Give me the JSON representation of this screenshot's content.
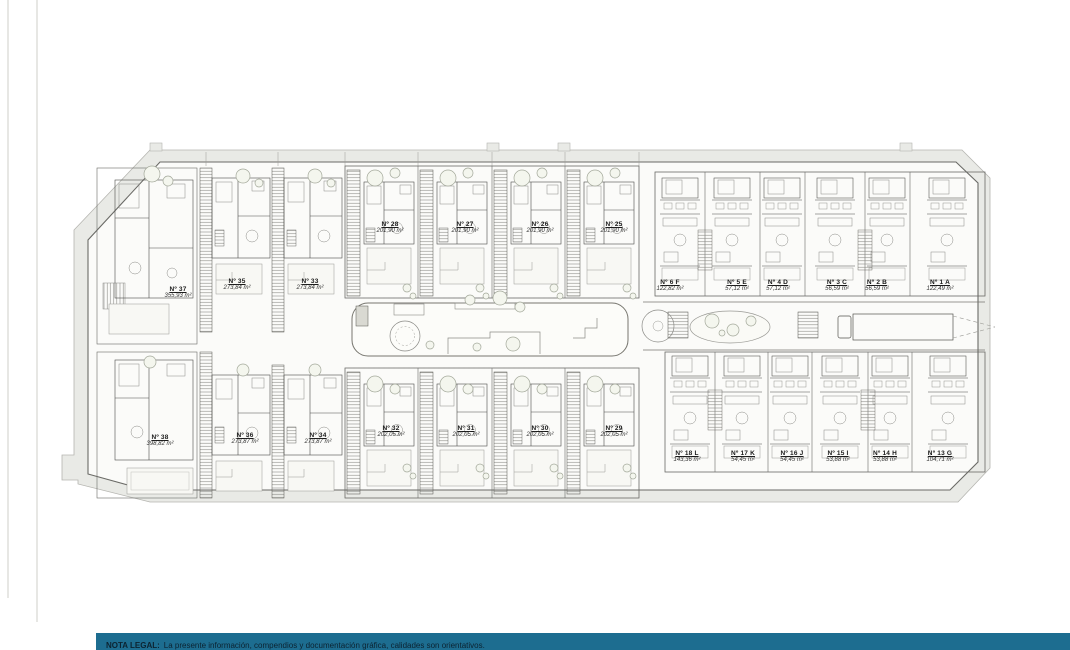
{
  "colors": {
    "teal_bar": "#1d6d90",
    "site_band": "#e9eae6",
    "plan_line": "#4d4d4a"
  },
  "legal": {
    "label": "NOTA LEGAL:",
    "text": "La presente información, compendios y documentación gráfica, calidades son orientativos."
  },
  "units": {
    "villas_top": [
      {
        "label": "Nº 37",
        "area": "355,93 m²"
      },
      {
        "label": "Nº 35",
        "area": "273,84 m²"
      },
      {
        "label": "Nº 33",
        "area": "273,84 m²"
      },
      {
        "label": "Nº 28",
        "area": "201,90 m²"
      },
      {
        "label": "Nº 27",
        "area": "201,90 m²"
      },
      {
        "label": "Nº 26",
        "area": "201,90 m²"
      },
      {
        "label": "Nº 25",
        "area": "201,90 m²"
      }
    ],
    "villas_bottom": [
      {
        "label": "Nº 38",
        "area": "398,82 m²"
      },
      {
        "label": "Nº 36",
        "area": "273,87 m²"
      },
      {
        "label": "Nº 34",
        "area": "273,87 m²"
      },
      {
        "label": "Nº 32",
        "area": "202,05 m²"
      },
      {
        "label": "Nº 31",
        "area": "202,05 m²"
      },
      {
        "label": "Nº 30",
        "area": "202,05 m²"
      },
      {
        "label": "Nº 29",
        "area": "202,05 m²"
      }
    ],
    "apartments_top": [
      {
        "label": "Nº 6 F",
        "area": "122,82 m²"
      },
      {
        "label": "Nº 5 E",
        "area": "57,12 m²"
      },
      {
        "label": "Nº 4 D",
        "area": "57,12 m²"
      },
      {
        "label": "Nº 3 C",
        "area": "56,59 m²"
      },
      {
        "label": "Nº 2 B",
        "area": "56,59 m²"
      },
      {
        "label": "Nº 1 A",
        "area": "122,49 m²"
      }
    ],
    "apartments_bottom": [
      {
        "label": "Nº 18 L",
        "area": "143,36 m²"
      },
      {
        "label": "Nº 17 K",
        "area": "54,45 m²"
      },
      {
        "label": "Nº 16 J",
        "area": "54,45 m²"
      },
      {
        "label": "Nº 15 I",
        "area": "53,88 m²"
      },
      {
        "label": "Nº 14 H",
        "area": "53,88 m²"
      },
      {
        "label": "Nº 13 G",
        "area": "104,71 m²"
      }
    ]
  }
}
